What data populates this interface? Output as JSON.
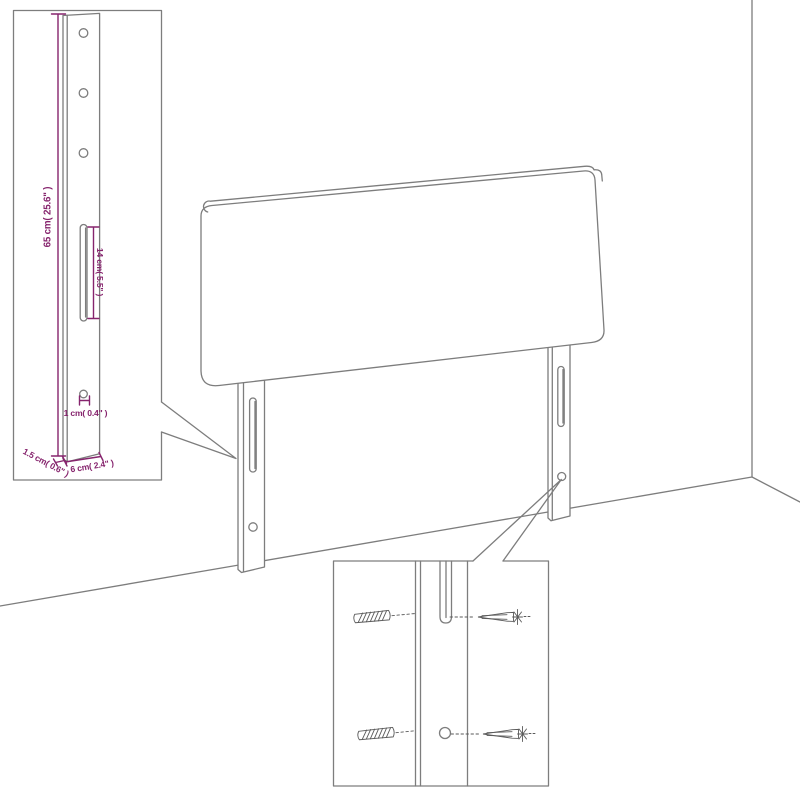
{
  "diagram": {
    "description": "headboard assembly dimension diagram",
    "colors": {
      "background": "#ffffff",
      "drawing_line_gray": "#7d7d7d",
      "hardware_gray": "#5a5a5a",
      "dimension_purple": "#86246d"
    },
    "leg_inset": {
      "height_label": "65 cm( 25.6\" )",
      "slot_label": "14 cm( 5.5\" )",
      "hole_label": "1 cm( 0.4\" )",
      "thickness_label": "1.5 cm( 0.6\" )",
      "width_label": "6 cm( 2.4\" )"
    }
  }
}
